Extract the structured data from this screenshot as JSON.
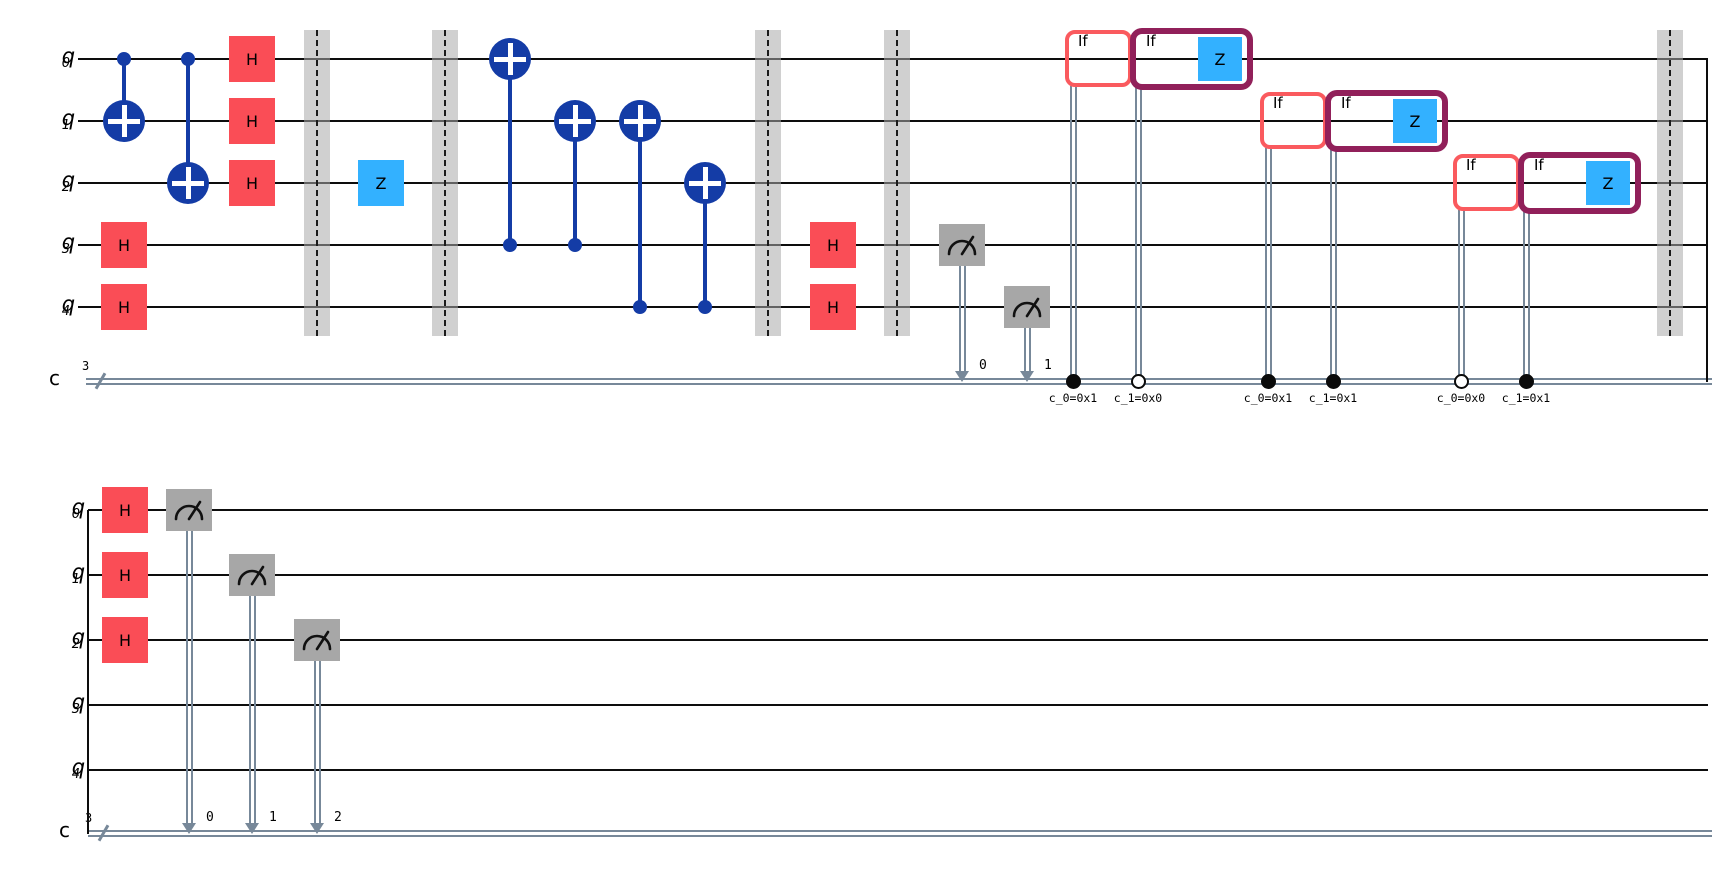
{
  "figure": {
    "width": 1722,
    "height": 882,
    "background": "#ffffff"
  },
  "colors": {
    "wire": "#0d0d0d",
    "classical": "#778899",
    "h_gate": "#FA4D56",
    "cx_blue": "#143CA6",
    "z_gate": "#33B1FF",
    "measure_fill": "#A7A7A7",
    "measure_glyph": "#111111",
    "barrier_band": "rgba(170,170,170,0.55)",
    "barrier_dash": "#1a1a1a",
    "if_outer": "#FA5A5E",
    "if_inner": "#91205A",
    "dot_fill": "#0a0a0a"
  },
  "row1": {
    "qubits": [
      {
        "name": "q",
        "sub": "0"
      },
      {
        "name": "q",
        "sub": "1"
      },
      {
        "name": "q",
        "sub": "2"
      },
      {
        "name": "q",
        "sub": "3"
      },
      {
        "name": "q",
        "sub": "4"
      }
    ],
    "clbit": {
      "name": "c",
      "size": "3"
    },
    "geometry": {
      "x1": 78,
      "x2": 1708,
      "cwx1": 86,
      "cwx2": 1712,
      "qy": [
        59,
        121,
        183,
        245,
        307
      ],
      "cy": 381,
      "slash_x": 100,
      "fold_x": 1707,
      "fold_side": "right"
    },
    "gates": [
      {
        "type": "h",
        "q": 3,
        "x": 124,
        "label": "H"
      },
      {
        "type": "h",
        "q": 4,
        "x": 124,
        "label": "H"
      },
      {
        "type": "h",
        "q": 0,
        "x": 252,
        "label": "H"
      },
      {
        "type": "h",
        "q": 1,
        "x": 252,
        "label": "H"
      },
      {
        "type": "h",
        "q": 2,
        "x": 252,
        "label": "H"
      },
      {
        "type": "z",
        "q": 2,
        "x": 381,
        "label": "Z"
      },
      {
        "type": "h",
        "q": 3,
        "x": 833,
        "label": "H"
      },
      {
        "type": "h",
        "q": 4,
        "x": 833,
        "label": "H"
      }
    ],
    "cx": [
      {
        "control": 0,
        "target": 1,
        "x": 124
      },
      {
        "control": 0,
        "target": 2,
        "x": 188
      },
      {
        "control": 3,
        "target": 0,
        "x": 510
      },
      {
        "control": 3,
        "target": 1,
        "x": 575
      },
      {
        "control": 4,
        "target": 1,
        "x": 640
      },
      {
        "control": 4,
        "target": 2,
        "x": 705
      }
    ],
    "barriers": [
      317,
      445,
      768,
      897,
      1670
    ],
    "measures": [
      {
        "q": 3,
        "x": 962,
        "bit": "0"
      },
      {
        "q": 4,
        "x": 1027,
        "bit": "1"
      }
    ],
    "if_blocks": [
      {
        "q": 0,
        "variant": "outer",
        "x": 1065,
        "w": 67,
        "wire_x": 1073,
        "dot": "filled",
        "condition": "c_0=0x1",
        "label": "If",
        "gate_label": null
      },
      {
        "q": 0,
        "variant": "inner",
        "x": 1130,
        "w": 123,
        "wire_x": 1138,
        "dot": "open",
        "condition": "c_1=0x0",
        "label": "If",
        "gate_label": "Z"
      },
      {
        "q": 1,
        "variant": "outer",
        "x": 1260,
        "w": 67,
        "wire_x": 1268,
        "dot": "filled",
        "condition": "c_0=0x1",
        "label": "If",
        "gate_label": null
      },
      {
        "q": 1,
        "variant": "inner",
        "x": 1325,
        "w": 123,
        "wire_x": 1333,
        "dot": "filled",
        "condition": "c_1=0x1",
        "label": "If",
        "gate_label": "Z"
      },
      {
        "q": 2,
        "variant": "outer",
        "x": 1453,
        "w": 67,
        "wire_x": 1461,
        "dot": "open",
        "condition": "c_0=0x0",
        "label": "If",
        "gate_label": null
      },
      {
        "q": 2,
        "variant": "inner",
        "x": 1518,
        "w": 123,
        "wire_x": 1526,
        "dot": "filled",
        "condition": "c_1=0x1",
        "label": "If",
        "gate_label": "Z"
      }
    ]
  },
  "row2": {
    "qubits": [
      {
        "name": "q",
        "sub": "0"
      },
      {
        "name": "q",
        "sub": "1"
      },
      {
        "name": "q",
        "sub": "2"
      },
      {
        "name": "q",
        "sub": "3"
      },
      {
        "name": "q",
        "sub": "4"
      }
    ],
    "clbit": {
      "name": "c",
      "size": "3"
    },
    "geometry": {
      "x1": 88,
      "x2": 1708,
      "cwx1": 88,
      "cwx2": 1712,
      "qy": [
        510,
        575,
        640,
        705,
        770
      ],
      "cy": 833,
      "slash_x": 103,
      "fold_x": 88,
      "fold_side": "left"
    },
    "gates": [
      {
        "type": "h",
        "q": 0,
        "x": 125,
        "label": "H"
      },
      {
        "type": "h",
        "q": 1,
        "x": 125,
        "label": "H"
      },
      {
        "type": "h",
        "q": 2,
        "x": 125,
        "label": "H"
      }
    ],
    "cx": [],
    "barriers": [],
    "measures": [
      {
        "q": 0,
        "x": 189,
        "bit": "0"
      },
      {
        "q": 1,
        "x": 252,
        "bit": "1"
      },
      {
        "q": 2,
        "x": 317,
        "bit": "2"
      }
    ],
    "if_blocks": []
  }
}
